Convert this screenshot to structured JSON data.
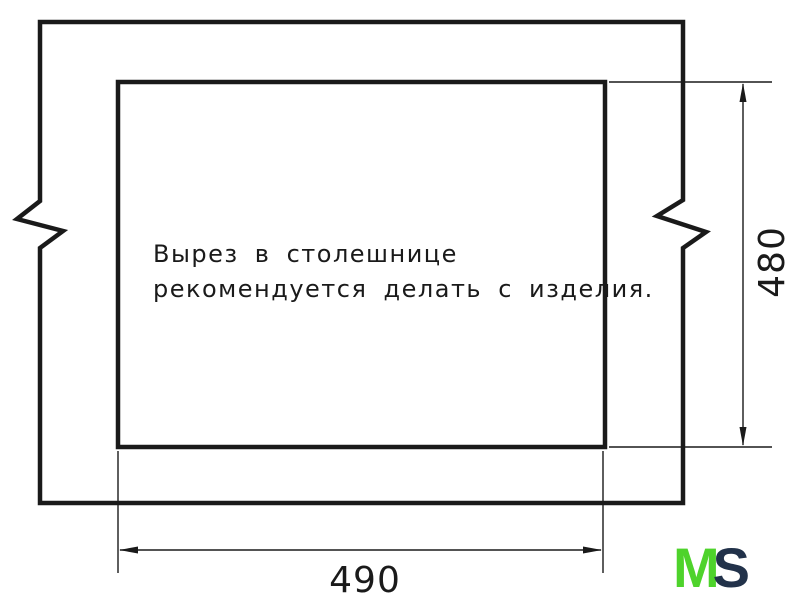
{
  "drawing": {
    "line_color": "#1a1a1a",
    "note": {
      "line1": "Вырез в столешнице",
      "line2": "рекомендуется делать с изделия."
    },
    "dimensions": {
      "cutout_width": "490",
      "cutout_height": "480"
    }
  },
  "logo": {
    "m": "M",
    "s": "S",
    "m_color": "#4ed32b",
    "s_color": "#22324a"
  }
}
